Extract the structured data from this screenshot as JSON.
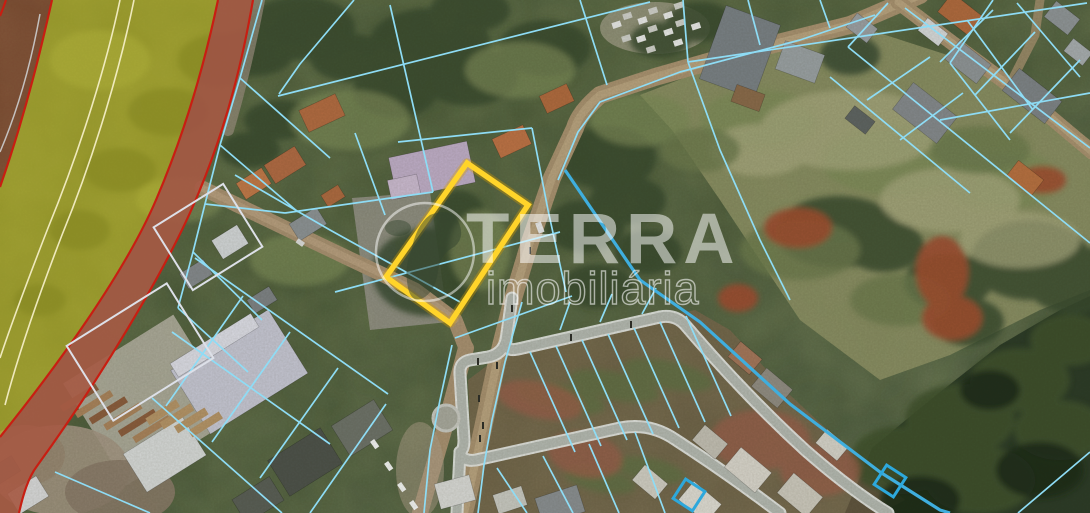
{
  "watermark": {
    "brand": "TERRA",
    "subtitle": "imobiliária",
    "logo": "globe-icon",
    "color": "#ffffff"
  },
  "map": {
    "type": "satellite-cadastral-aerial",
    "colors": {
      "parcel_line": "#8edcf5",
      "parcel_line_thick": "#3faede",
      "highlight_stroke": "#ffd42a",
      "highlight_halo": "rgba(216,158,0,0.35)",
      "buffer_arc_red": "#c81e12",
      "zone_red_fill": "rgba(158,52,38,0.48)",
      "zone_yellow_fill": "rgba(214,204,30,0.52)",
      "marker_blue": "#2da8dc",
      "outline_rect": "#dde0e8",
      "track_line": "rgba(248,243,205,0.9)"
    },
    "highlight_parcel": {
      "points": [
        [
          467,
          163
        ],
        [
          528,
          205
        ],
        [
          450,
          323
        ],
        [
          386,
          277
        ]
      ],
      "stroke_width": 5.5
    },
    "marker_squares": [
      {
        "cx": 689,
        "cy": 495,
        "size": 23,
        "rot": 33
      },
      {
        "cx": 890,
        "cy": 481,
        "size": 23,
        "rot": 33
      }
    ],
    "outline_rects": [
      {
        "cx": 208,
        "cy": 237,
        "w": 82,
        "h": 74,
        "rot": -32
      },
      {
        "cx": 140,
        "cy": 352,
        "w": 118,
        "h": 88,
        "rot": -32
      }
    ],
    "buffer_zones": {
      "fills": [
        {
          "path": "M 218,0 C 205,62 186,130 156,200 C 126,270 62,360 0,437 L 0,513 L 19,513 C 23,495 28,478 37,466 C 98,382 168,268 199,192 C 228,122 243,58 253,0 Z",
          "fill": "rgba(155,114,88,0.85)"
        },
        {
          "path": "M 0,0 L 52,0 C 43,40 27,110 0,187 Z",
          "fill": "rgba(158,52,38,0.48)"
        },
        {
          "path": "M 52,0 C 43,40 27,110 0,187 L 0,437 C 62,360 126,270 156,200 C 186,130 205,62 218,0 Z",
          "fill": "rgba(214,204,30,0.52)"
        },
        {
          "path": "M 218,0 C 205,62 186,130 156,200 C 126,270 62,360 0,437 L 0,513 L 19,513 C 23,495 28,478 37,466 C 98,382 168,268 199,192 C 228,122 243,58 253,0 Z",
          "fill": "rgba(178,62,45,0.42)"
        }
      ],
      "lines": [
        {
          "path": "M 6,0 C 4,6 2,11 0,16",
          "stroke": "#c81e12",
          "width": 2.2
        },
        {
          "path": "M 52,0 C 43,40 27,110 0,187",
          "stroke": "#c81e12",
          "width": 2.2
        },
        {
          "path": "M 218,0 C 205,62 186,130 156,200 C 126,270 62,360 0,437",
          "stroke": "#c81e12",
          "width": 2.2
        },
        {
          "path": "M 253,0 C 243,58 228,122 199,192 C 168,268 98,382 37,466 C 28,478 23,495 19,513",
          "stroke": "#c81e12",
          "width": 2.2
        },
        {
          "path": "M 120,0 C 107,62 82,145 48,228 C 27,282 12,322 0,358",
          "stroke": "rgba(248,243,205,0.9)",
          "width": 1.6
        },
        {
          "path": "M 134,0 C 121,64 96,152 62,235 C 40,292 20,348 5,405",
          "stroke": "rgba(248,243,205,0.9)",
          "width": 1.6
        },
        {
          "path": "M 40,14 C 32,58 20,105 0,152",
          "stroke": "rgba(215,222,228,0.8)",
          "width": 1.5
        }
      ]
    },
    "parcel_lines": {
      "color": "#8edcf5",
      "width": 1.7,
      "thick_color": "#3faede",
      "thick_width": 3.2,
      "thin": [
        [
          [
            262,
            0
          ],
          [
            240,
            78
          ],
          [
            220,
            145
          ],
          [
            205,
            204
          ],
          [
            193,
            252
          ],
          [
            178,
            308
          ]
        ],
        [
          [
            205,
            204
          ],
          [
            285,
            213
          ]
        ],
        [
          [
            285,
            213
          ],
          [
            433,
            192
          ]
        ],
        [
          [
            390,
            5
          ],
          [
            433,
            192
          ]
        ],
        [
          [
            355,
            133
          ],
          [
            385,
            215
          ]
        ],
        [
          [
            278,
            96
          ],
          [
            650,
            2
          ]
        ],
        [
          [
            354,
            0
          ],
          [
            300,
            64
          ],
          [
            279,
            94
          ]
        ],
        [
          [
            240,
            78
          ],
          [
            330,
            158
          ]
        ],
        [
          [
            220,
            145
          ],
          [
            298,
            212
          ]
        ],
        [
          [
            193,
            252
          ],
          [
            262,
            320
          ]
        ],
        [
          [
            178,
            308
          ],
          [
            248,
            372
          ]
        ],
        [
          [
            235,
            175
          ],
          [
            330,
            230
          ],
          [
            460,
            302
          ]
        ],
        [
          [
            335,
            292
          ],
          [
            560,
            232
          ]
        ],
        [
          [
            455,
            338
          ],
          [
            572,
            296
          ]
        ],
        [
          [
            398,
            142
          ],
          [
            532,
            128
          ]
        ],
        [
          [
            532,
            128
          ],
          [
            548,
            210
          ],
          [
            566,
            292
          ]
        ],
        [
          [
            580,
            0
          ],
          [
            607,
            85
          ]
        ],
        [
          [
            683,
            0
          ],
          [
            688,
            62
          ]
        ],
        [
          [
            688,
            62
          ],
          [
            1087,
            3
          ]
        ],
        [
          [
            688,
            62
          ],
          [
            720,
            150
          ],
          [
            760,
            240
          ],
          [
            790,
            300
          ]
        ],
        [
          [
            950,
            63
          ],
          [
            1010,
            140
          ]
        ],
        [
          [
            967,
            20
          ],
          [
            1033,
            110
          ]
        ],
        [
          [
            1017,
            3
          ],
          [
            1080,
            77
          ]
        ],
        [
          [
            940,
            120
          ],
          [
            1090,
            93
          ]
        ],
        [
          [
            993,
            0
          ],
          [
            950,
            63
          ]
        ],
        [
          [
            848,
            47
          ],
          [
            1090,
            243
          ]
        ],
        [
          [
            830,
            77
          ],
          [
            970,
            193
          ]
        ],
        [
          [
            867,
            100
          ],
          [
            930,
            57
          ]
        ],
        [
          [
            900,
            140
          ],
          [
            963,
            93
          ]
        ],
        [
          [
            888,
            3
          ],
          [
            848,
            47
          ]
        ],
        [
          [
            993,
            10
          ],
          [
            940,
            62
          ]
        ],
        [
          [
            1035,
            32
          ],
          [
            975,
            95
          ]
        ],
        [
          [
            1080,
            60
          ],
          [
            1010,
            133
          ]
        ],
        [
          [
            905,
            8
          ],
          [
            1090,
            148
          ]
        ],
        [
          [
            760,
            45
          ],
          [
            748,
            0
          ]
        ],
        [
          [
            830,
            28
          ],
          [
            820,
            0
          ]
        ],
        [
          [
            558,
            180
          ],
          [
            578,
            132
          ],
          [
            600,
            102
          ],
          [
            680,
            72
          ],
          [
            800,
            40
          ],
          [
            875,
            15
          ]
        ],
        [
          [
            530,
            352
          ],
          [
            575,
            452
          ]
        ],
        [
          [
            556,
            346
          ],
          [
            601,
            446
          ]
        ],
        [
          [
            582,
            340
          ],
          [
            627,
            440
          ]
        ],
        [
          [
            608,
            334
          ],
          [
            653,
            434
          ]
        ],
        [
          [
            634,
            328
          ],
          [
            679,
            428
          ]
        ],
        [
          [
            660,
            322
          ],
          [
            705,
            422
          ]
        ],
        [
          [
            686,
            316
          ],
          [
            731,
            416
          ]
        ],
        [
          [
            497,
            468
          ],
          [
            527,
            513
          ]
        ],
        [
          [
            543,
            456
          ],
          [
            573,
            513
          ]
        ],
        [
          [
            589,
            444
          ],
          [
            619,
            513
          ]
        ],
        [
          [
            635,
            432
          ],
          [
            665,
            513
          ]
        ],
        [
          [
            290,
            332
          ],
          [
            212,
            442
          ]
        ],
        [
          [
            338,
            368
          ],
          [
            260,
            478
          ]
        ],
        [
          [
            386,
            404
          ],
          [
            310,
            513
          ]
        ],
        [
          [
            243,
            296
          ],
          [
            166,
            406
          ]
        ],
        [
          [
            195,
            258
          ],
          [
            388,
            394
          ]
        ],
        [
          [
            172,
            332
          ],
          [
            330,
            444
          ]
        ],
        [
          [
            152,
            398
          ],
          [
            282,
            513
          ]
        ],
        [
          [
            55,
            472
          ],
          [
            150,
            513
          ]
        ],
        [
          [
            1018,
            513
          ],
          [
            1090,
            452
          ]
        ],
        [
          [
            522,
            302
          ],
          [
            505,
            362
          ],
          [
            492,
            420
          ],
          [
            484,
            465
          ],
          [
            478,
            513
          ]
        ],
        [
          [
            452,
            345
          ],
          [
            440,
            400
          ],
          [
            430,
            450
          ],
          [
            424,
            513
          ]
        ],
        [
          [
            560,
            330
          ],
          [
            570,
            302
          ]
        ],
        [
          [
            600,
            322
          ],
          [
            612,
            294
          ]
        ],
        [
          [
            642,
            314
          ],
          [
            656,
            288
          ]
        ]
      ],
      "thick": [
        [
          [
            565,
            170
          ],
          [
            640,
            280
          ],
          [
            700,
            322
          ],
          [
            790,
            404
          ],
          [
            880,
            472
          ],
          [
            940,
            510
          ],
          [
            950,
            513
          ]
        ]
      ]
    }
  }
}
